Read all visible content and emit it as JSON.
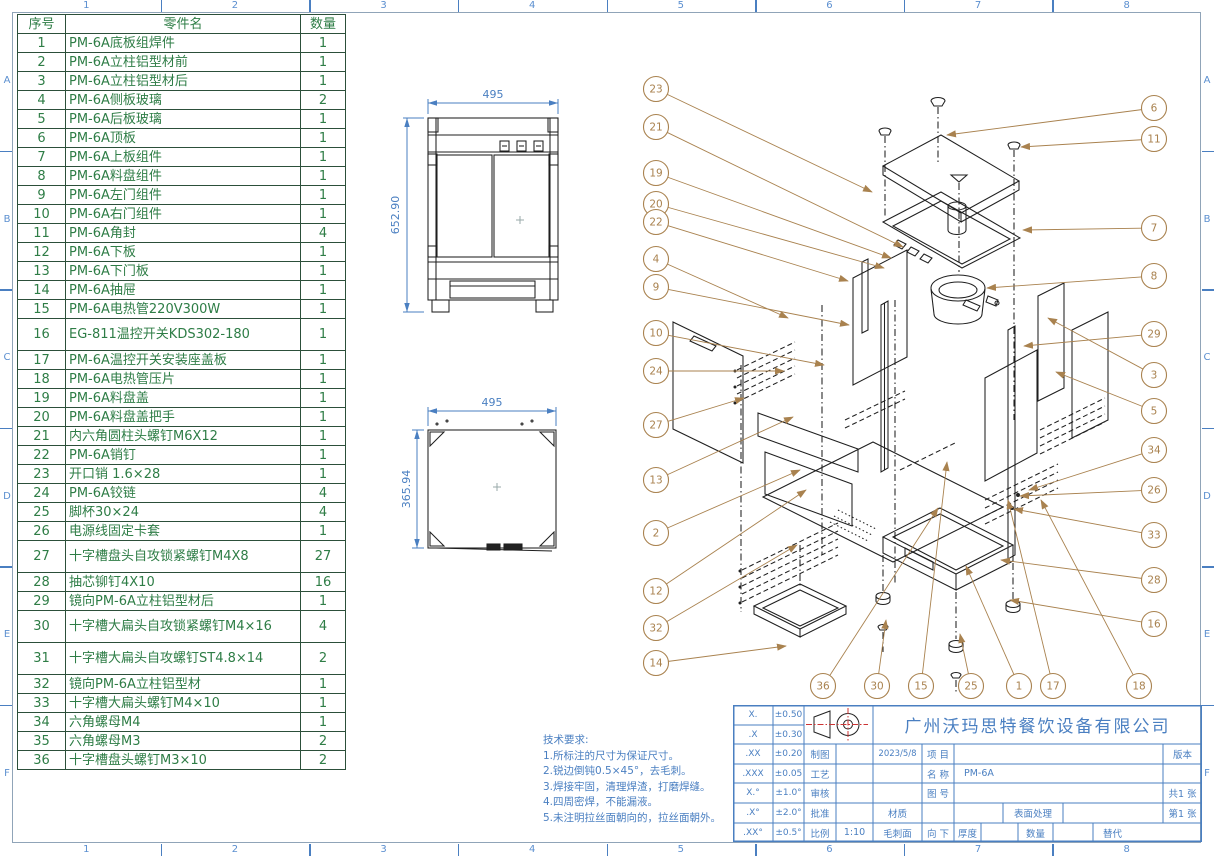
{
  "sheet": {
    "zone_columns": [
      "1",
      "2",
      "3",
      "4",
      "5",
      "6",
      "7",
      "8"
    ],
    "zone_rows": [
      "A",
      "B",
      "C",
      "D",
      "E",
      "F"
    ],
    "colors": {
      "table_green": "#2e7d46",
      "title_blue": "#4a7fc1",
      "balloon_tan": "#a9824f",
      "line_black": "#1f1f1f",
      "centerline_red": "#cc3333"
    }
  },
  "parts_table": {
    "headers": [
      "序号",
      "零件名",
      "数量"
    ],
    "rows": [
      {
        "no": "1",
        "name": "PM-6A底板组焊件",
        "qty": "1"
      },
      {
        "no": "2",
        "name": "PM-6A立柱铝型材前",
        "qty": "1"
      },
      {
        "no": "3",
        "name": "PM-6A立柱铝型材后",
        "qty": "1"
      },
      {
        "no": "4",
        "name": "PM-6A侧板玻璃",
        "qty": "2"
      },
      {
        "no": "5",
        "name": "PM-6A后板玻璃",
        "qty": "1"
      },
      {
        "no": "6",
        "name": "PM-6A顶板",
        "qty": "1"
      },
      {
        "no": "7",
        "name": "PM-6A上板组件",
        "qty": "1"
      },
      {
        "no": "8",
        "name": "PM-6A料盘组件",
        "qty": "1"
      },
      {
        "no": "9",
        "name": "PM-6A左门组件",
        "qty": "1"
      },
      {
        "no": "10",
        "name": "PM-6A右门组件",
        "qty": "1"
      },
      {
        "no": "11",
        "name": "PM-6A角封",
        "qty": "4"
      },
      {
        "no": "12",
        "name": "PM-6A下板",
        "qty": "1"
      },
      {
        "no": "13",
        "name": "PM-6A下门板",
        "qty": "1"
      },
      {
        "no": "14",
        "name": "PM-6A抽屉",
        "qty": "1"
      },
      {
        "no": "15",
        "name": "PM-6A电热管220V300W",
        "qty": "1"
      },
      {
        "no": "16",
        "name": "EG-811温控开关KDS302-180",
        "qty": "1"
      },
      {
        "no": "17",
        "name": "PM-6A温控开关安装座盖板",
        "qty": "1"
      },
      {
        "no": "18",
        "name": "PM-6A电热管压片",
        "qty": "1"
      },
      {
        "no": "19",
        "name": "PM-6A料盘盖",
        "qty": "1"
      },
      {
        "no": "20",
        "name": "PM-6A料盘盖把手",
        "qty": "1"
      },
      {
        "no": "21",
        "name": "内六角圆柱头螺钉M6X12",
        "qty": "1"
      },
      {
        "no": "22",
        "name": "PM-6A销钉",
        "qty": "1"
      },
      {
        "no": "23",
        "name": "开口销 1.6×28",
        "qty": "1"
      },
      {
        "no": "24",
        "name": "PM-6A铰链",
        "qty": "4"
      },
      {
        "no": "25",
        "name": "脚杯30×24",
        "qty": "4"
      },
      {
        "no": "26",
        "name": "电源线固定卡套",
        "qty": "1"
      },
      {
        "no": "27",
        "name": "十字槽盘头自攻锁紧螺钉M4X8",
        "qty": "27"
      },
      {
        "no": "28",
        "name": "抽芯铆钉4X10",
        "qty": "16"
      },
      {
        "no": "29",
        "name": "镜向PM-6A立柱铝型材后",
        "qty": "1"
      },
      {
        "no": "30",
        "name": "十字槽大扁头自攻锁紧螺钉M4×16",
        "qty": "4"
      },
      {
        "no": "31",
        "name": "十字槽大扁头自攻螺钉ST4.8×14",
        "qty": "2"
      },
      {
        "no": "32",
        "name": "镜向PM-6A立柱铝型材",
        "qty": "1"
      },
      {
        "no": "33",
        "name": "十字槽大扁头螺钉M4×10",
        "qty": "1"
      },
      {
        "no": "34",
        "name": "六角螺母M4",
        "qty": "1"
      },
      {
        "no": "35",
        "name": "六角螺母M3",
        "qty": "2"
      },
      {
        "no": "36",
        "name": "十字槽盘头螺钉M3×10",
        "qty": "2"
      }
    ]
  },
  "views": {
    "front": {
      "width_dim": "495",
      "height_dim": "652.90"
    },
    "top": {
      "width_dim": "495",
      "depth_dim": "365.94"
    }
  },
  "tech_notes": {
    "title": "技术要求:",
    "lines": [
      "1.所标注的尺寸为保证尺寸。",
      "2.锐边倒钝0.5×45°，去毛刺。",
      "3.焊接牢固，清理焊渣，打磨焊缝。",
      "4.四周密焊，不能漏液。",
      "5.未注明拉丝面朝向的，拉丝面朝外。"
    ]
  },
  "title_block": {
    "company": "广州沃玛思特餐饮设备有限公司",
    "tolerances": [
      {
        "label": "X.",
        "value": "±0.50"
      },
      {
        "label": ".X",
        "value": "±0.30"
      },
      {
        "label": ".XX",
        "value": "±0.20"
      },
      {
        "label": ".XXX",
        "value": "±0.05"
      },
      {
        "label": "X.°",
        "value": "±1.0°"
      },
      {
        "label": ".X°",
        "value": "±2.0°"
      },
      {
        "label": ".XX°",
        "value": "±0.5°"
      }
    ],
    "fields": {
      "drawn_label": "制图",
      "drawn_date": "2023/5/8",
      "project_label": "项 目",
      "version_label": "版本",
      "process_label": "工艺",
      "name_label": "名 称",
      "name_value": "PM-6A",
      "check_label": "审核",
      "drawing_no_label": "图 号",
      "sheets_total": "共1 张",
      "approve_label": "批准",
      "material_label": "材质",
      "surface_label": "表面处理",
      "sheet_no": "第1 张",
      "scale_label": "比例",
      "scale_value": "1:10",
      "burr_label": "毛刺面",
      "burr_value": "向 下",
      "thickness_label": "厚度",
      "qty_label": "数量",
      "substitute_label": "替代"
    }
  },
  "exploded_view": {
    "balloons": [
      {
        "n": "23",
        "x": 656,
        "y": 89,
        "tx": 872,
        "ty": 192
      },
      {
        "n": "21",
        "x": 656,
        "y": 127,
        "tx": 903,
        "ty": 247
      },
      {
        "n": "19",
        "x": 656,
        "y": 173,
        "tx": 891,
        "ty": 258
      },
      {
        "n": "20",
        "x": 656,
        "y": 204,
        "tx": 884,
        "ty": 268
      },
      {
        "n": "22",
        "x": 656,
        "y": 222,
        "tx": 848,
        "ty": 281
      },
      {
        "n": "4",
        "x": 656,
        "y": 259,
        "tx": 788,
        "ty": 318
      },
      {
        "n": "9",
        "x": 656,
        "y": 287,
        "tx": 849,
        "ty": 325
      },
      {
        "n": "10",
        "x": 656,
        "y": 333,
        "tx": 824,
        "ty": 365
      },
      {
        "n": "24",
        "x": 656,
        "y": 371,
        "tx": 784,
        "ty": 371
      },
      {
        "n": "27",
        "x": 656,
        "y": 425,
        "tx": 744,
        "ty": 398
      },
      {
        "n": "13",
        "x": 656,
        "y": 480,
        "tx": 793,
        "ty": 417
      },
      {
        "n": "2",
        "x": 656,
        "y": 533,
        "tx": 800,
        "ty": 470
      },
      {
        "n": "12",
        "x": 656,
        "y": 591,
        "tx": 806,
        "ty": 490
      },
      {
        "n": "32",
        "x": 656,
        "y": 628,
        "tx": 797,
        "ty": 545
      },
      {
        "n": "14",
        "x": 656,
        "y": 663,
        "tx": 786,
        "ty": 646
      },
      {
        "n": "36",
        "x": 823,
        "y": 686,
        "tx": 938,
        "ty": 508
      },
      {
        "n": "30",
        "x": 877,
        "y": 686,
        "tx": 886,
        "ty": 620
      },
      {
        "n": "15",
        "x": 921,
        "y": 686,
        "tx": 947,
        "ty": 462
      },
      {
        "n": "25",
        "x": 971,
        "y": 686,
        "tx": 960,
        "ty": 634
      },
      {
        "n": "1",
        "x": 1019,
        "y": 686,
        "tx": 966,
        "ty": 566
      },
      {
        "n": "17",
        "x": 1053,
        "y": 686,
        "tx": 1008,
        "ty": 500
      },
      {
        "n": "18",
        "x": 1139,
        "y": 686,
        "tx": 1041,
        "ty": 500
      },
      {
        "n": "6",
        "x": 1154,
        "y": 108,
        "tx": 947,
        "ty": 135
      },
      {
        "n": "11",
        "x": 1154,
        "y": 139,
        "tx": 1021,
        "ty": 147
      },
      {
        "n": "7",
        "x": 1154,
        "y": 228,
        "tx": 1023,
        "ty": 230
      },
      {
        "n": "8",
        "x": 1154,
        "y": 276,
        "tx": 987,
        "ty": 288
      },
      {
        "n": "29",
        "x": 1154,
        "y": 334,
        "tx": 1024,
        "ty": 346
      },
      {
        "n": "3",
        "x": 1154,
        "y": 375,
        "tx": 1048,
        "ty": 318
      },
      {
        "n": "5",
        "x": 1154,
        "y": 411,
        "tx": 1056,
        "ty": 372
      },
      {
        "n": "34",
        "x": 1154,
        "y": 450,
        "tx": 1029,
        "ty": 490
      },
      {
        "n": "26",
        "x": 1154,
        "y": 490,
        "tx": 1020,
        "ty": 496
      },
      {
        "n": "33",
        "x": 1154,
        "y": 535,
        "tx": 1014,
        "ty": 509
      },
      {
        "n": "28",
        "x": 1154,
        "y": 580,
        "tx": 1001,
        "ty": 560
      },
      {
        "n": "16",
        "x": 1154,
        "y": 624,
        "tx": 1010,
        "ty": 600
      }
    ]
  }
}
